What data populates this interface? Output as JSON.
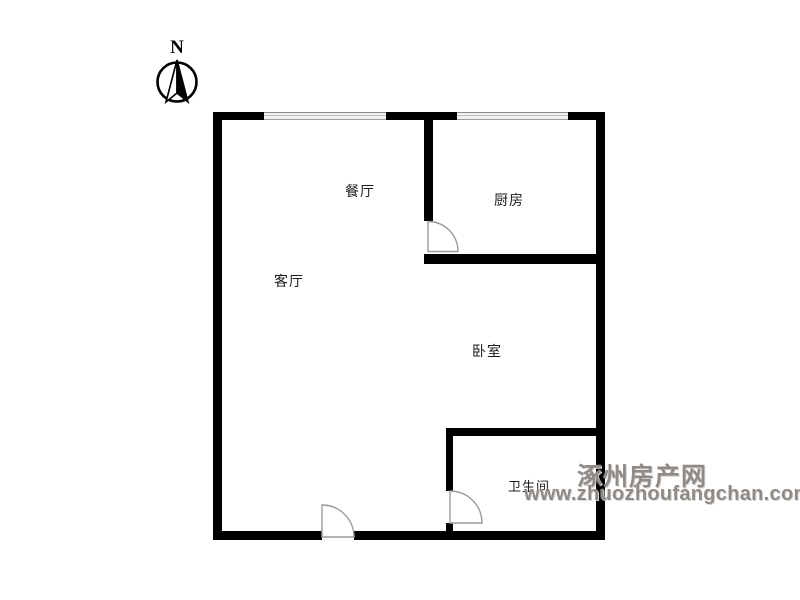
{
  "compass": {
    "label": "N"
  },
  "rooms": {
    "dining": {
      "label": "餐厅"
    },
    "kitchen": {
      "label": "厨房"
    },
    "living": {
      "label": "客厅"
    },
    "bedroom": {
      "label": "卧室"
    },
    "bathroom": {
      "label": "卫生间"
    }
  },
  "watermark": {
    "site_name": "涿州房产网",
    "site_url": "www.zhuozhoufangchan.com"
  },
  "colors": {
    "wall": "#000000",
    "door_stroke": "#9c9c9c",
    "watermark": "#8f8a86",
    "label_text": "#1c1c1c"
  }
}
